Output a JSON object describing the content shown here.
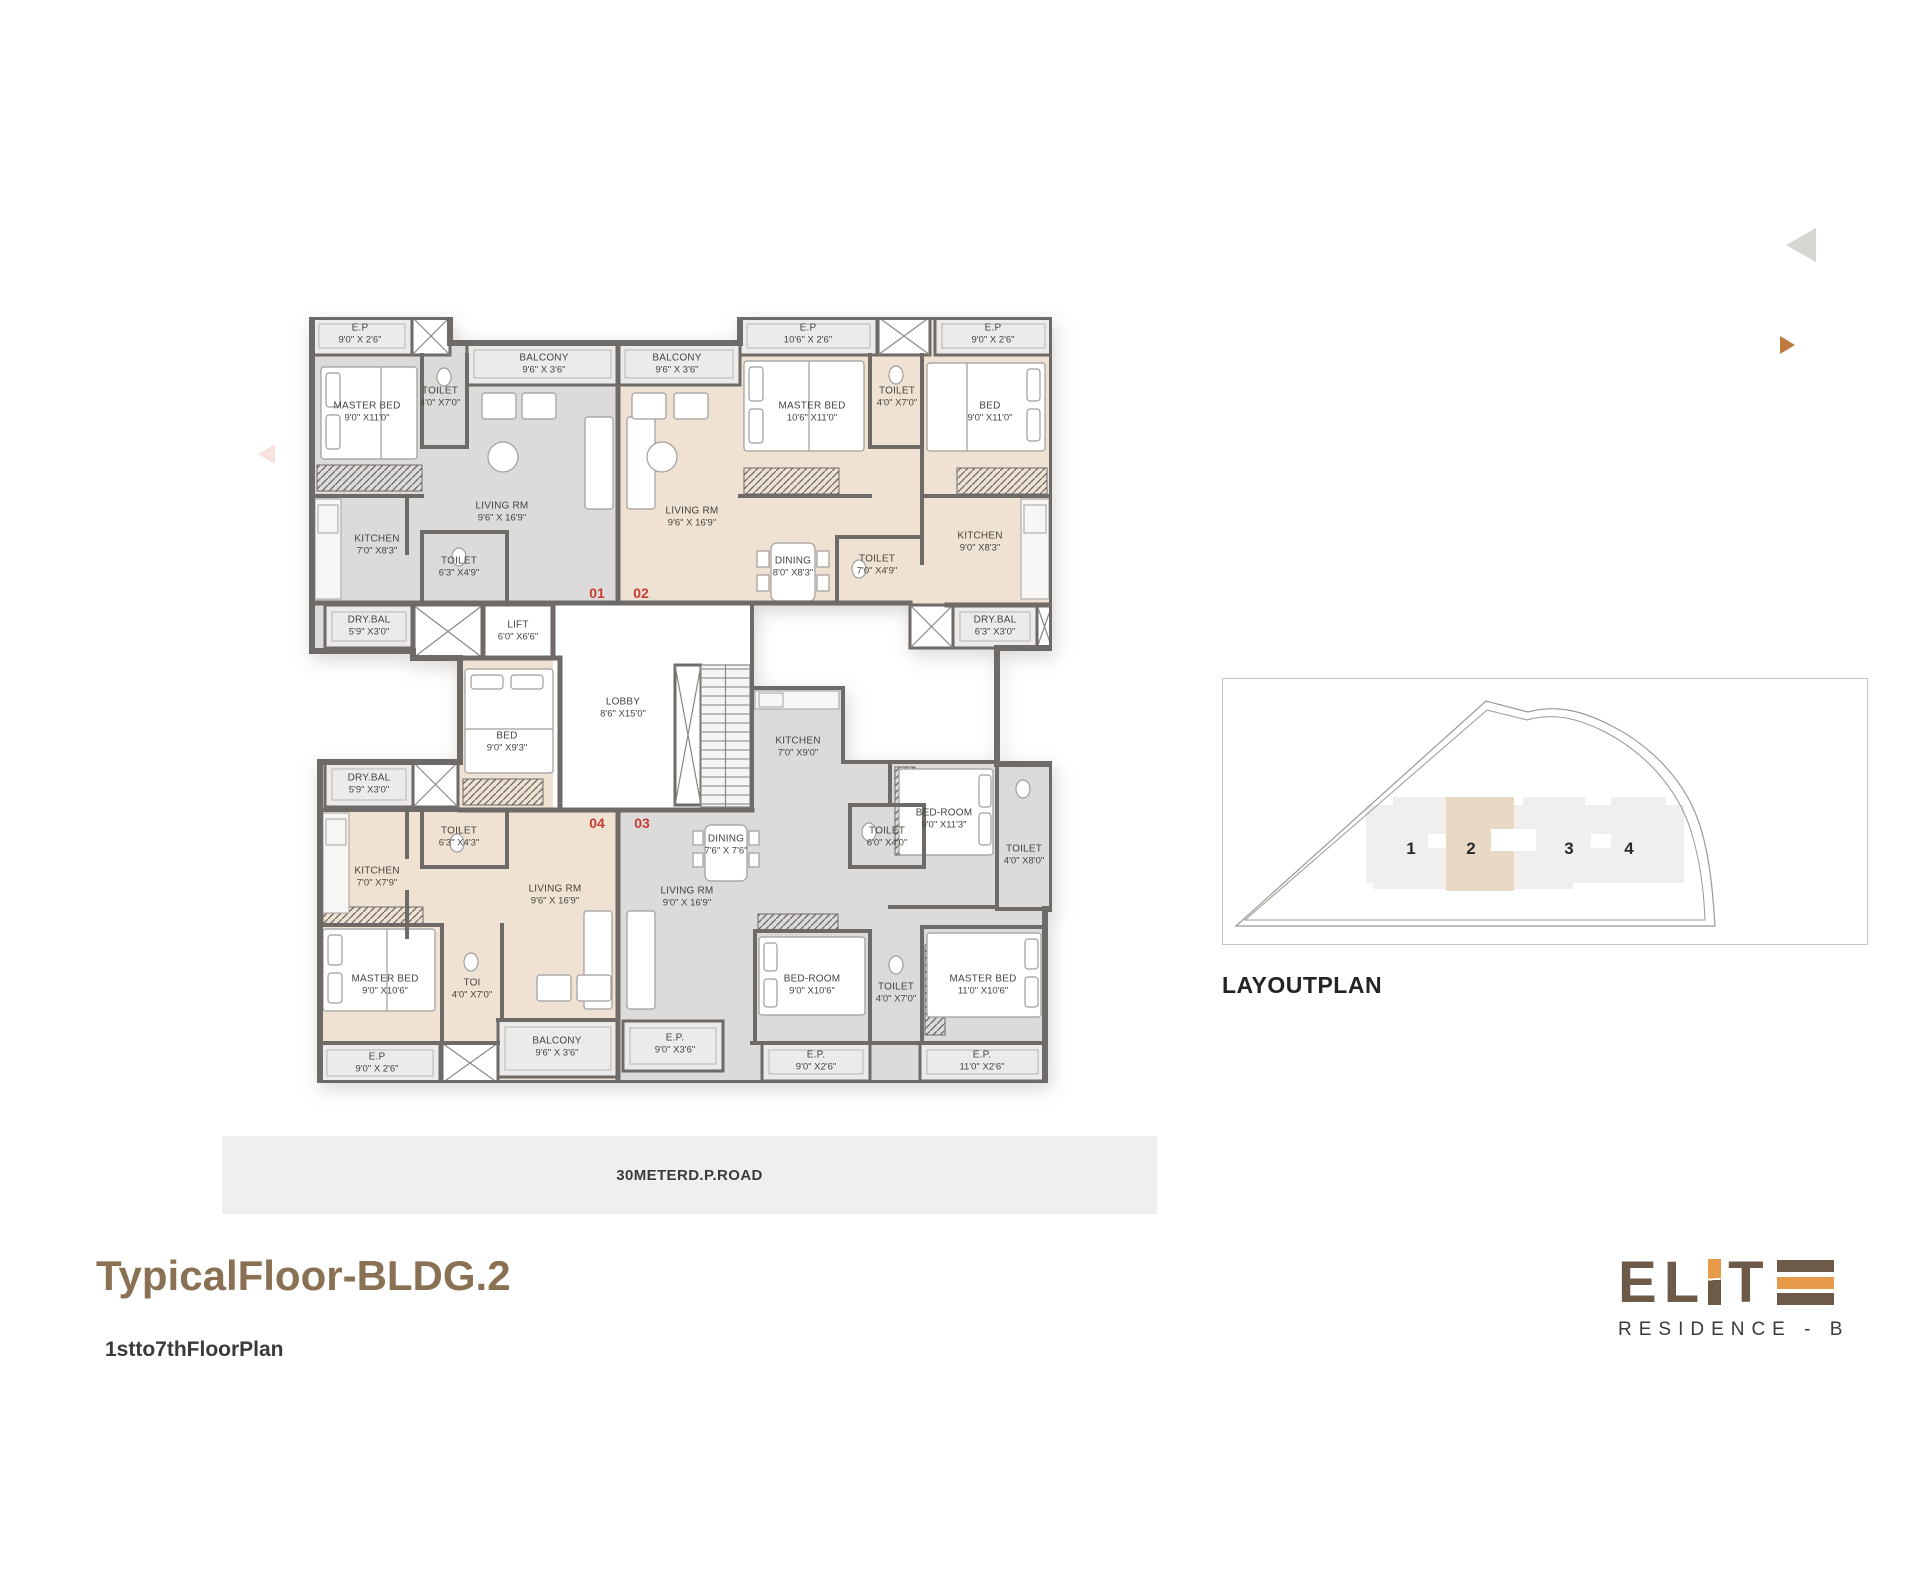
{
  "page": {
    "title": "TypicalFloor-BLDG.2",
    "subtitle": "1stto7thFloorPlan",
    "road_label": "30METERD.P.ROAD"
  },
  "logo": {
    "brand": "ELITE",
    "residence": "RESIDENCE - B",
    "brown": "#6d5a49",
    "orange": "#e89a4b"
  },
  "layoutplan": {
    "heading": "LAYOUTPLAN",
    "highlighted_block": "2",
    "blocks": [
      {
        "label": "1",
        "x": 188,
        "y": 170
      },
      {
        "label": "2",
        "x": 248,
        "y": 170
      },
      {
        "label": "3",
        "x": 346,
        "y": 170
      },
      {
        "label": "4",
        "x": 406,
        "y": 170
      }
    ]
  },
  "colors": {
    "accent_brown": "#8a7154",
    "badge_red": "#c63c35",
    "unit_gray": "#dcdbd9",
    "unit_beige": "#efe2d2",
    "wall_gray": "#6e6a67"
  },
  "plan": {
    "unit_badges": [
      {
        "label": "01",
        "x": 290,
        "y": 276
      },
      {
        "label": "02",
        "x": 334,
        "y": 276
      },
      {
        "label": "04",
        "x": 290,
        "y": 506
      },
      {
        "label": "03",
        "x": 335,
        "y": 506
      }
    ],
    "rooms": [
      {
        "unit": "01",
        "name": "E.P",
        "dims": "9'0\" X 2'6\"",
        "x": 53,
        "y": 17
      },
      {
        "unit": "01",
        "name": "MASTER BED",
        "dims": "9'0\" X11'0\"",
        "x": 60,
        "y": 95
      },
      {
        "unit": "01",
        "name": "TOILET",
        "dims": "4'0\" X7'0\"",
        "x": 133,
        "y": 80,
        "w": 52
      },
      {
        "unit": "01",
        "name": "BALCONY",
        "dims": "9'6\" X 3'6\"",
        "x": 237,
        "y": 47,
        "w": 58
      },
      {
        "unit": "common",
        "name": "BALCONY",
        "dims": "9'6\" X 3'6\"",
        "x": 370,
        "y": 47,
        "w": 58
      },
      {
        "unit": "01",
        "name": "LIVING RM",
        "dims": "9'6\" X 16'9\"",
        "x": 195,
        "y": 195
      },
      {
        "unit": "01",
        "name": "KITCHEN",
        "dims": "7'0\" X8'3\"",
        "x": 70,
        "y": 228
      },
      {
        "unit": "01",
        "name": "TOILET",
        "dims": "6'3\" X4'9\"",
        "x": 152,
        "y": 250
      },
      {
        "unit": "01",
        "name": "DRY.BAL",
        "dims": "5'9\" X3'0\"",
        "x": 62,
        "y": 309
      },
      {
        "unit": "common",
        "name": "LIFT",
        "dims": "6'0\" X6'6\"",
        "x": 211,
        "y": 314
      },
      {
        "unit": "common",
        "name": "LOBBY",
        "dims": "8'6\" X15'0\"",
        "x": 316,
        "y": 391
      },
      {
        "unit": "02",
        "name": "E.P",
        "dims": "10'6\" X 2'6\"",
        "x": 501,
        "y": 17
      },
      {
        "unit": "02",
        "name": "MASTER BED",
        "dims": "10'6\" X11'0\"",
        "x": 505,
        "y": 95
      },
      {
        "unit": "02",
        "name": "TOILET",
        "dims": "4'0\" X7'0\"",
        "x": 590,
        "y": 80,
        "w": 52
      },
      {
        "unit": "02",
        "name": "E.P",
        "dims": "9'0\" X 2'6\"",
        "x": 686,
        "y": 17
      },
      {
        "unit": "02",
        "name": "BED",
        "dims": "9'0\" X11'0\"",
        "x": 683,
        "y": 95
      },
      {
        "unit": "02",
        "name": "LIVING RM",
        "dims": "9'6\" X 16'9\"",
        "x": 385,
        "y": 200
      },
      {
        "unit": "02",
        "name": "DINING",
        "dims": "8'0\" X8'3\"",
        "x": 486,
        "y": 250
      },
      {
        "unit": "02",
        "name": "TOILET",
        "dims": "7'0\" X4'9\"",
        "x": 570,
        "y": 248
      },
      {
        "unit": "02",
        "name": "KITCHEN",
        "dims": "9'0\" X8'3\"",
        "x": 673,
        "y": 225
      },
      {
        "unit": "02",
        "name": "DRY.BAL",
        "dims": "6'3\" X3'0\"",
        "x": 688,
        "y": 309
      },
      {
        "unit": "04",
        "name": "BED",
        "dims": "9'0\" X9'3\"",
        "x": 200,
        "y": 425
      },
      {
        "unit": "04",
        "name": "DRY.BAL",
        "dims": "5'9\" X3'0\"",
        "x": 62,
        "y": 467
      },
      {
        "unit": "04",
        "name": "TOILET",
        "dims": "6'3\" X4'3\"",
        "x": 152,
        "y": 520
      },
      {
        "unit": "04",
        "name": "KITCHEN",
        "dims": "7'0\" X7'9\"",
        "x": 70,
        "y": 560
      },
      {
        "unit": "04",
        "name": "LIVING RM",
        "dims": "9'6\" X 16'9\"",
        "x": 248,
        "y": 578
      },
      {
        "unit": "04",
        "name": "MASTER BED",
        "dims": "9'0\" X10'6\"",
        "x": 78,
        "y": 668
      },
      {
        "unit": "04",
        "name": "TOI",
        "dims": "4'0\" X7'0\"",
        "x": 165,
        "y": 672,
        "w": 50
      },
      {
        "unit": "04",
        "name": "E.P",
        "dims": "9'0\" X 2'6\"",
        "x": 70,
        "y": 746
      },
      {
        "unit": "04",
        "name": "BALCONY",
        "dims": "9'6\" X 3'6\"",
        "x": 250,
        "y": 730,
        "w": 58
      },
      {
        "unit": "03",
        "name": "KITCHEN",
        "dims": "7'0\" X9'0\"",
        "x": 491,
        "y": 430
      },
      {
        "unit": "03",
        "name": "DINING",
        "dims": "7'6\" X 7'6\"",
        "x": 419,
        "y": 528
      },
      {
        "unit": "03",
        "name": "LIVING RM",
        "dims": "9'0\" X 16'9\"",
        "x": 380,
        "y": 580
      },
      {
        "unit": "03",
        "name": "TOILET",
        "dims": "6'0\" X4'0\"",
        "x": 580,
        "y": 520,
        "w": 56
      },
      {
        "unit": "03",
        "name": "BED-ROOM",
        "dims": "9'0\" X11'3\"",
        "x": 637,
        "y": 502
      },
      {
        "unit": "03",
        "name": "TOILET",
        "dims": "4'0\" X8'0\"",
        "x": 717,
        "y": 538,
        "w": 52
      },
      {
        "unit": "03",
        "name": "E.P.",
        "dims": "9'0\" X3'6\"",
        "x": 368,
        "y": 727
      },
      {
        "unit": "03",
        "name": "BED-ROOM",
        "dims": "9'0\" X10'6\"",
        "x": 505,
        "y": 668
      },
      {
        "unit": "03",
        "name": "TOILET",
        "dims": "4'0\" X7'0\"",
        "x": 589,
        "y": 676,
        "w": 52
      },
      {
        "unit": "03",
        "name": "MASTER BED",
        "dims": "11'0\" X10'6\"",
        "x": 676,
        "y": 668
      },
      {
        "unit": "03",
        "name": "E.P.",
        "dims": "9'0\" X2'6\"",
        "x": 509,
        "y": 744
      },
      {
        "unit": "03",
        "name": "E.P.",
        "dims": "11'0\" X2'6\"",
        "x": 675,
        "y": 744
      }
    ]
  }
}
